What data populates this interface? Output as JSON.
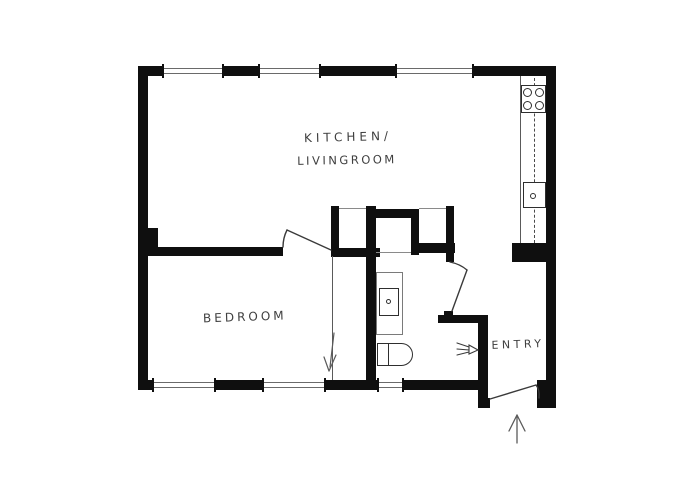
{
  "plan": {
    "title": "apartment-floor-plan",
    "labels": {
      "kitchen_line1": "KITCHEN/",
      "kitchen_line2": "LIVINGROOM",
      "bedroom": "BEDROOM",
      "entry": "ENTRY"
    },
    "colors": {
      "wall": "#0f0f0f",
      "thin_line": "#5a5a5a",
      "fixture_line": "#2e2e2e",
      "text": "#3f3f3f",
      "bg": "#ffffff"
    },
    "icons": {
      "stove": "stove-four-burners-icon",
      "kitchen_sink": "kitchen-sink-icon",
      "bathroom_sink": "washbasin-icon",
      "toilet": "toilet-icon",
      "entrance_arrow": "entrance-direction-arrow-icon",
      "sliding_arrow": "sliding-door-arrow-icon",
      "vent": "ventilation-arrow-icon"
    }
  }
}
